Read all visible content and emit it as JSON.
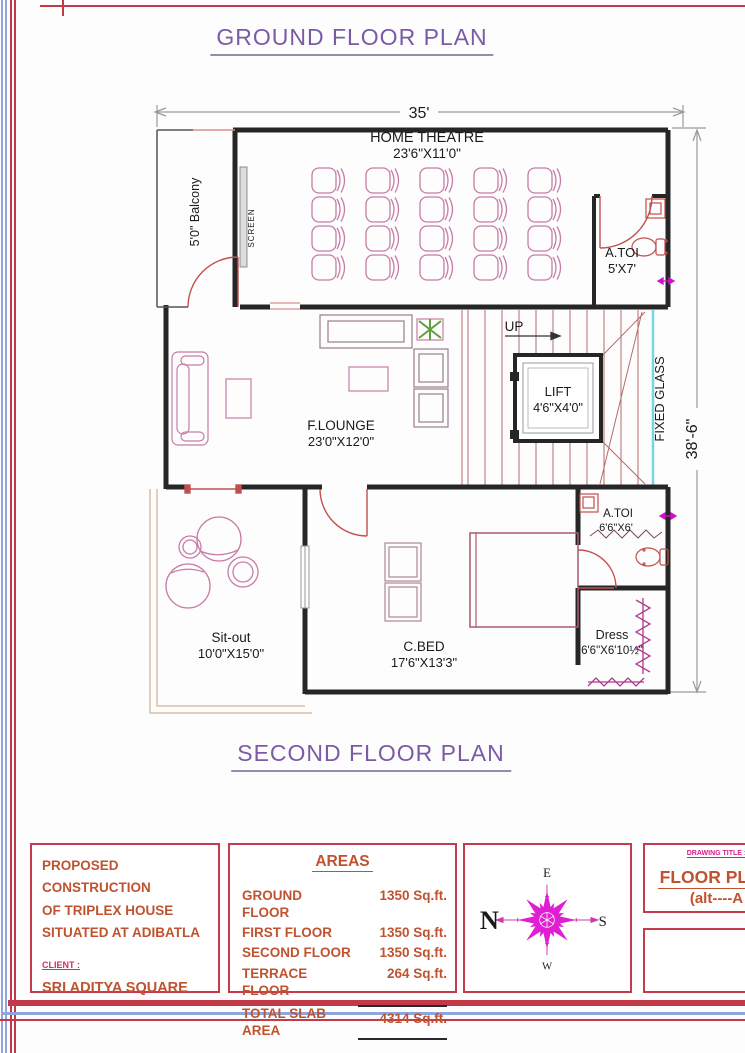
{
  "titles": {
    "ground": "GROUND FLOOR PLAN",
    "second": "SECOND FLOOR PLAN"
  },
  "dims": {
    "width": "35'",
    "height": "38'-6\""
  },
  "plan": {
    "balcony": "5'0\" Balcony",
    "screen": "SCREEN",
    "home_theatre_name": "HOME THEATRE",
    "home_theatre_size": "23'6\"X11'0\"",
    "atoi_top_name": "A.TOI",
    "atoi_top_size": "5'X7'",
    "up": "UP",
    "lift_name": "LIFT",
    "lift_size": "4'6\"X4'0\"",
    "fixed_glass": "FIXED GLASS",
    "lounge_name": "F.LOUNGE",
    "lounge_size": "23'0\"X12'0\"",
    "cbed_name": "C.BED",
    "cbed_size": "17'6\"X13'3\"",
    "sitout_name": "Sit-out",
    "sitout_size": "10'0\"X15'0\"",
    "atoi_bot_name": "A.TOI",
    "atoi_bot_size": "6'6\"X6'",
    "dress_name": "Dress",
    "dress_size": "6'6\"X6'10½\""
  },
  "title_block": {
    "project_line1": "PROPOSED CONSTRUCTION",
    "project_line2": "OF TRIPLEX HOUSE",
    "project_line3": "SITUATED AT ADIBATLA",
    "client_label": "CLIENT :",
    "client_name": "SRI ADITYA SQUARE",
    "areas_title": "AREAS",
    "areas_rows": [
      {
        "label": "GROUND FLOOR",
        "value": "1350 Sq.ft."
      },
      {
        "label": "FIRST FLOOR",
        "value": "1350 Sq.ft."
      },
      {
        "label": "SECOND FLOOR",
        "value": "1350 Sq.ft."
      },
      {
        "label": "TERRACE FLOOR",
        "value": "264 Sq.ft."
      }
    ],
    "total_label": "TOTAL SLAB AREA",
    "total_value": "4314 Sq.ft.",
    "compass": {
      "n": "N",
      "e": "E",
      "s": "S",
      "w": "W"
    },
    "drawing_title_label": "DRAWING TITLE :",
    "drawing_title": "FLOOR PLAN",
    "drawing_alt": "(alt----A"
  },
  "colors": {
    "wall": "#262626",
    "door_red": "#c0504d",
    "furniture_pink": "#c77ca6",
    "dim_magenta": "#e020d0",
    "title_purple": "#7b5aa6",
    "accent_orange": "#c0532f",
    "border_red": "#c43b4e",
    "border_blue": "#8ea6dc",
    "fixed_glass_cyan": "#7ad4e4",
    "plant_green": "#5da03c",
    "compass_magenta": "#e01ed2"
  }
}
